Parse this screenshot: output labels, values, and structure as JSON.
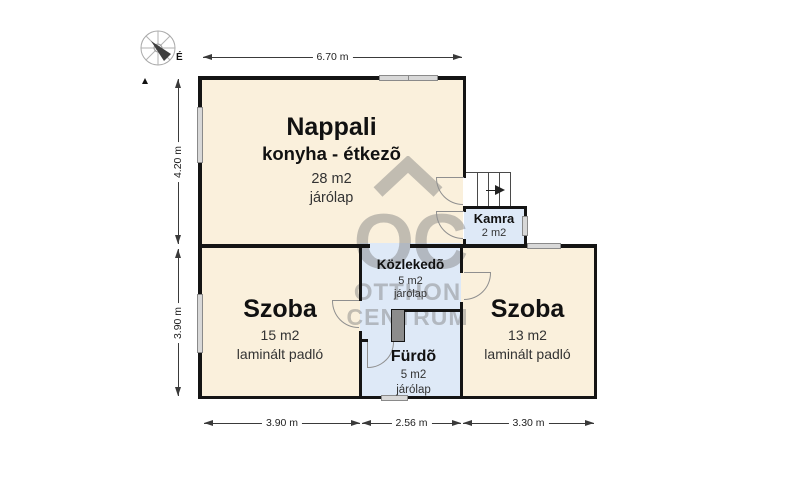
{
  "compass": {
    "north_label": "É"
  },
  "watermark": {
    "monogram": "OC",
    "line1": "OTTHON",
    "line2": "CENTRUM"
  },
  "rooms": {
    "nappali": {
      "name": "Nappali",
      "subtitle": "konyha - étkezõ",
      "area": "28 m2",
      "floor": "járólap"
    },
    "szoba_left": {
      "name": "Szoba",
      "area": "15 m2",
      "floor": "laminált padló"
    },
    "szoba_right": {
      "name": "Szoba",
      "area": "13 m2",
      "floor": "laminált padló"
    },
    "kozlekedo": {
      "name": "Közlekedõ",
      "area": "5 m2",
      "floor": "járólap"
    },
    "furdo": {
      "name": "Fürdõ",
      "area": "5 m2",
      "floor": "járólap"
    },
    "kamra": {
      "name": "Kamra",
      "area": "2 m2"
    }
  },
  "dimensions": {
    "top_width": "6.70 m",
    "left_upper": "4.20 m",
    "left_lower": "3.90 m",
    "bottom_left": "3.90 m",
    "bottom_middle": "2.56 m",
    "bottom_right": "3.30 m"
  },
  "colors": {
    "room_dry": "#FAF0DC",
    "room_wet": "#DEE9F7",
    "wall": "#141414",
    "window_fill": "#D8D8D8",
    "watermark_gray": "#7D7D7D"
  }
}
